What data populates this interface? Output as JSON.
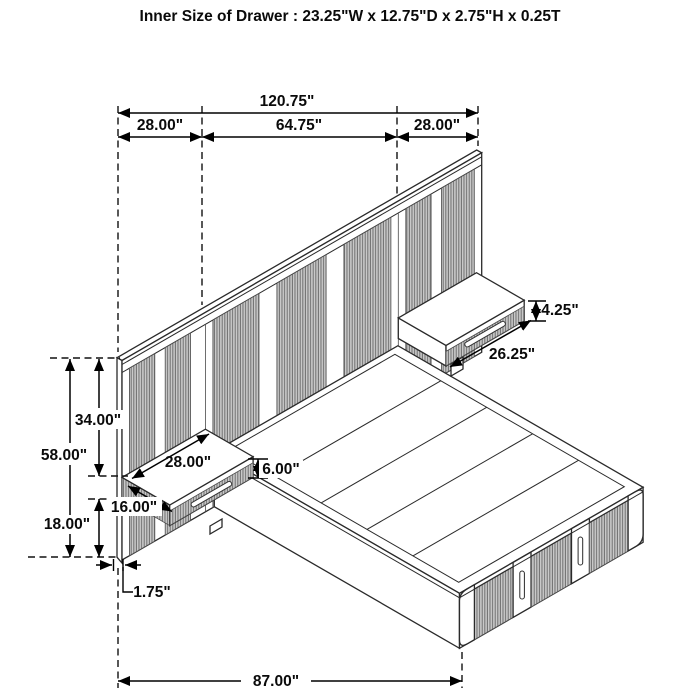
{
  "title": "Inner Size of Drawer : 23.25\"W x 12.75\"D x 2.75\"H x 0.25T",
  "dimensions": {
    "overall_width": "120.75\"",
    "left_section_width": "28.00\"",
    "middle_section_width": "64.75\"",
    "right_section_width": "28.00\"",
    "right_nightstand_drawer_height": "4.25\"",
    "right_nightstand_width": "26.25\"",
    "headboard_upper_height": "34.00\"",
    "headboard_total_height": "58.00\"",
    "left_nightstand_width": "28.00\"",
    "left_nightstand_height": "6.00\"",
    "left_nightstand_depth": "16.00\"",
    "headboard_lower_height": "18.00\"",
    "headboard_thickness": "1.75\"",
    "bed_length": "87.00\""
  },
  "colors": {
    "line": "#000000",
    "slat_fill": "#c9c9c9",
    "slat_stripe": "#6e6e6e",
    "background": "#ffffff"
  }
}
